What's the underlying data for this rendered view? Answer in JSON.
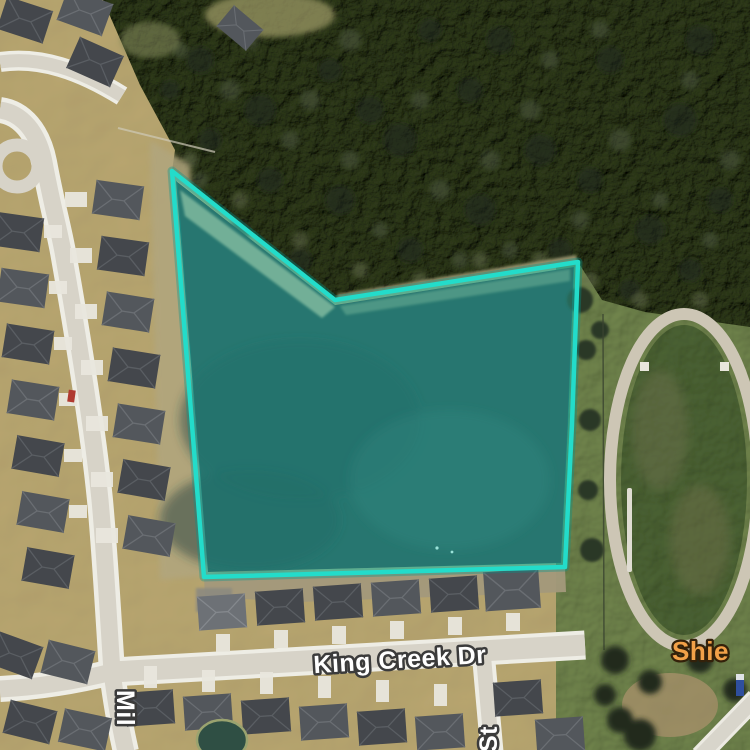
{
  "map": {
    "view_mode": "satellite",
    "labels": {
      "street_main": "King Creek Dr",
      "street_left_partial": "Mil",
      "street_bottom_partial": "St",
      "poi_partial": "Shie"
    },
    "label_styles": {
      "street_fill": "#ffffff",
      "street_outline": "#3b3b3b",
      "poi_fill": "#f2a148",
      "poi_outline": "#33210a"
    },
    "parcel": {
      "points": "172,171 335,300 578,262 572,424 565,567 204,577",
      "fill": "rgba(34,216,202,0.30)",
      "stroke": "#23dcca",
      "stroke_width": "4.5",
      "glow": "rgba(0,150,140,0.35)"
    },
    "scene_colors": {
      "water": "#315553",
      "forest": "#515a3e",
      "residential_ground": "#c0b287",
      "field": "#788c5c",
      "road": "#d7d3c8",
      "sidewalk": "#eeede5",
      "track_surface": "#cdc6b5",
      "roof_dark": "#44474c",
      "roof_mid": "#53575c",
      "roof_light": "#6d7176"
    }
  }
}
